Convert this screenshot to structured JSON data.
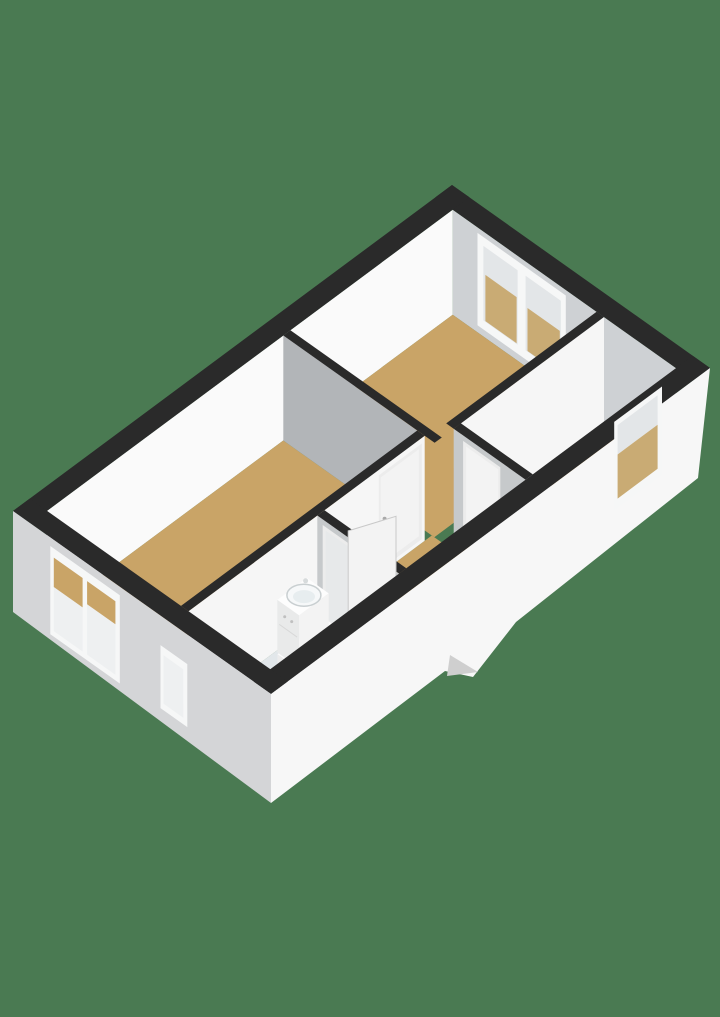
{
  "app": {
    "type": "3d-floorplan-render",
    "rooms_visible": 5,
    "text_labels": []
  },
  "palette": {
    "bg": "#4a7a52",
    "band": "#2a2a2a",
    "floorTan": "#c9a467",
    "floorBath": "#e2e7ea",
    "wallWhite": "#fafafa",
    "wallBright": "#f6f6f6",
    "wallGrayLt": "#ced1d4",
    "wallGrayMd": "#b2b5b8",
    "wallGrayDr": "#c6c9cb",
    "extSW": "#d4d5d7",
    "extSE": "#f7f7f7",
    "frame": "#f6f7f7",
    "doorFrame": "#ececec",
    "leaf": "#f3f3f3",
    "doorOpen": "#e7e9ea",
    "glass": "#e3e6e8",
    "glassLt": "#eef0f1",
    "reveal": "#c9ab74",
    "fixture": "#fbfbfb",
    "fixtureSide": "#ececec",
    "fixtureSide2": "#f3f3f3",
    "handle": "#a9a9a9",
    "edge": "#c9c9c9"
  },
  "scene": {
    "projection": {
      "origin": [
        452,
        185
      ],
      "a": [
        -47.72,
        35.43
      ],
      "b": [
        49.62,
        35.19
      ],
      "drop": 105,
      "length_m": 9.2,
      "width_m": 5.2
    },
    "elements": [
      {
        "t": "screenPoly",
        "pts": [
          [
            0,
            0
          ],
          [
            720,
            0
          ],
          [
            720,
            1017
          ],
          [
            0,
            1017
          ]
        ],
        "fill": "bg",
        "name": "background"
      },
      {
        "t": "faceB",
        "s": 0.35,
        "t0": 0.35,
        "t1": 4.85,
        "z0": 0,
        "z1": 1,
        "fill": "wallGrayLt",
        "name": "ne-wall-inner-face"
      },
      {
        "t": "faceA",
        "tt": 0.35,
        "s0": 0.35,
        "s1": 8.85,
        "z0": 0,
        "z1": 1,
        "fill": "wallWhite",
        "name": "nw-wall-inner-face"
      },
      {
        "t": "faceB",
        "s": 0.34,
        "t0": 0.84,
        "t1": 2.62,
        "z0": 0.06,
        "z1": 0.94,
        "fill": "frame",
        "name": "bedroom1-window-frame"
      },
      {
        "t": "faceB",
        "s": 0.33,
        "t0": 0.95,
        "t1": 1.64,
        "z0": 0.15,
        "z1": 0.86,
        "fill": "glass",
        "name": "bedroom1-window-pane-left"
      },
      {
        "t": "faceB",
        "s": 0.33,
        "t0": 1.8,
        "t1": 2.51,
        "z0": 0.15,
        "z1": 0.86,
        "fill": "glass",
        "name": "bedroom1-window-pane-right"
      },
      {
        "t": "faceB",
        "s": 0.32,
        "t0": 0.98,
        "t1": 1.61,
        "z0": 0.42,
        "z1": 0.86,
        "fill": "reveal",
        "name": "bedroom1-window-reveal-left"
      },
      {
        "t": "faceB",
        "s": 0.32,
        "t0": 1.83,
        "t1": 2.48,
        "z0": 0.45,
        "z1": 0.86,
        "fill": "reveal",
        "name": "bedroom1-window-reveal-right"
      },
      {
        "t": "rect",
        "s0": 0.35,
        "s1": 3.75,
        "t0": 0.35,
        "t1": 3.25,
        "z": 1,
        "fill": "floorTan",
        "name": "bedroom1-floor"
      },
      {
        "t": "rect",
        "s0": 0.35,
        "s1": 3.35,
        "t0": 3.4,
        "t1": 4.85,
        "z": 1,
        "fill": "floorTan",
        "name": "bedroom2-floor"
      },
      {
        "t": "rect",
        "s0": 3.9,
        "s1": 8.85,
        "t0": 0.35,
        "t1": 3.05,
        "z": 1,
        "fill": "floorTan",
        "name": "living-room-floor"
      },
      {
        "t": "polyPlan",
        "z": 1,
        "pts": [
          [
            3.75,
            3.2
          ],
          [
            3.75,
            3.4
          ],
          [
            3.5,
            3.4
          ],
          [
            3.5,
            4.85
          ],
          [
            6.0,
            4.85
          ],
          [
            6.0,
            3.2
          ]
        ],
        "fill": "floorTan",
        "name": "hallway-floor"
      },
      {
        "t": "rect",
        "s0": 6.15,
        "s1": 8.85,
        "t0": 3.2,
        "t1": 4.85,
        "z": 1,
        "fill": "floorBath",
        "name": "bathroom-floor"
      },
      {
        "t": "quad",
        "pts": [
          [
            3.47,
            4.35,
            0.05
          ],
          [
            2.7,
            4.6,
            0.05
          ],
          [
            2.7,
            4.6,
            1
          ],
          [
            3.47,
            4.35,
            1
          ]
        ],
        "fill": "leaf",
        "stroke": "edge",
        "name": "bedroom2-door-leaf-open"
      },
      {
        "t": "faceA",
        "tt": 3.4,
        "s0": 0.35,
        "s1": 3.35,
        "z0": 0,
        "z1": 1,
        "fill": "wallBright",
        "name": "partition-bed1-bed2-face"
      },
      {
        "t": "faceB",
        "s": 3.5,
        "t0": 3.4,
        "t1": 4.85,
        "z0": 0,
        "z1": 1,
        "fill": "wallGrayDr",
        "name": "partition-bed2-hall-face"
      },
      {
        "t": "faceB",
        "s": 3.49,
        "t0": 3.58,
        "t1": 4.33,
        "z0": 0.06,
        "z1": 0.97,
        "fill": "doorFrame",
        "name": "bedroom2-door-frame"
      },
      {
        "t": "faceB",
        "s": 3.48,
        "t0": 3.63,
        "t1": 4.28,
        "z0": 0.1,
        "z1": 0.93,
        "fill": "leaf",
        "name": "bedroom2-doorway"
      },
      {
        "t": "faceB",
        "s": 3.9,
        "t0": 0.35,
        "t1": 3.05,
        "z0": 0,
        "z1": 1,
        "fill": "wallGrayMd",
        "name": "partition-bed1-living-face"
      },
      {
        "t": "faceA",
        "tt": 3.2,
        "s0": 3.9,
        "s1": 8.85,
        "z0": 0,
        "z1": 1,
        "fill": "wallBright",
        "name": "partition-living-hall-face"
      },
      {
        "t": "faceA",
        "tt": 3.19,
        "s0": 3.95,
        "s1": 4.85,
        "z0": 0.06,
        "z1": 0.97,
        "fill": "doorFrame",
        "name": "living-room-door-frame"
      },
      {
        "t": "faceA",
        "tt": 3.18,
        "s0": 4.0,
        "s1": 4.8,
        "z0": 0.1,
        "z1": 0.93,
        "fill": "leaf",
        "name": "living-room-door"
      },
      {
        "t": "circle",
        "c": [
          4.72,
          3.18,
          0.52
        ],
        "r": 2,
        "fill": "handle",
        "name": "living-room-door-handle"
      },
      {
        "t": "faceB",
        "s": 6.15,
        "t0": 3.2,
        "t1": 4.85,
        "z0": 0,
        "z1": 1,
        "fill": "wallGrayDr",
        "name": "bathroom-wall-face"
      },
      {
        "t": "faceB",
        "s": 6.14,
        "t0": 3.3,
        "t1": 4.0,
        "z0": 0.06,
        "z1": 0.97,
        "fill": "doorFrame",
        "name": "bathroom-door-frame"
      },
      {
        "t": "faceB",
        "s": 6.13,
        "t0": 3.35,
        "t1": 3.95,
        "z0": 0.1,
        "z1": 0.93,
        "fill": "doorOpen",
        "name": "bathroom-doorway"
      },
      {
        "t": "rect",
        "s0": 0,
        "s1": 0.35,
        "t0": 0,
        "t1": 5.2,
        "z": 0,
        "fill": "band",
        "name": "ne-wall-top"
      },
      {
        "t": "rect",
        "s0": 0,
        "s1": 9.2,
        "t0": 0,
        "t1": 0.35,
        "z": 0,
        "fill": "band",
        "name": "nw-wall-top"
      },
      {
        "t": "rect",
        "s0": 0.35,
        "s1": 3.5,
        "t0": 3.25,
        "t1": 3.4,
        "z": 0,
        "fill": "band",
        "name": "partition-bed1-bed2-top"
      },
      {
        "t": "rect",
        "s0": 3.35,
        "s1": 3.5,
        "t0": 3.4,
        "t1": 4.85,
        "z": 0,
        "fill": "band",
        "name": "partition-bed2-hall-top"
      },
      {
        "t": "rect",
        "s0": 3.75,
        "s1": 3.9,
        "t0": 0.35,
        "t1": 3.4,
        "z": 0,
        "fill": "band",
        "name": "partition-bed1-living-top"
      },
      {
        "t": "rect",
        "s0": 3.9,
        "s1": 8.85,
        "t0": 3.05,
        "t1": 3.2,
        "z": 0,
        "fill": "band",
        "name": "partition-living-hall-top"
      },
      {
        "t": "rect",
        "s0": 6.0,
        "s1": 6.15,
        "t0": 3.2,
        "t1": 4.85,
        "z": 0,
        "fill": "band",
        "name": "bathroom-wall-top"
      },
      {
        "t": "quad",
        "pts": [
          [
            5.98,
            3.66,
            0.05
          ],
          [
            5.28,
            3.95,
            0.05
          ],
          [
            5.28,
            3.95,
            1
          ],
          [
            5.98,
            3.66,
            1
          ]
        ],
        "fill": "leaf",
        "stroke": "edge",
        "name": "bathroom-door-leaf-open"
      },
      {
        "t": "rect",
        "s0": 6.35,
        "s1": 7.35,
        "t0": 3.55,
        "t1": 4.4,
        "z": 0.8,
        "fill": "fixture",
        "name": "shower-tray-top"
      },
      {
        "t": "faceB",
        "s": 7.35,
        "t0": 3.55,
        "t1": 4.4,
        "z0": 0.8,
        "z1": 1,
        "fill": "fixtureSide",
        "name": "shower-tray-front"
      },
      {
        "t": "faceA",
        "tt": 4.4,
        "s0": 6.35,
        "s1": 7.35,
        "z0": 0.8,
        "z1": 1,
        "fill": "fixtureSide2",
        "name": "shower-tray-side"
      },
      {
        "t": "ellipse",
        "c": [
          6.28,
          3.97,
          0.78
        ],
        "rx": 7,
        "ry": 4.5,
        "fill": "#ffffff",
        "stroke": "#d2d5d6",
        "name": "toilet"
      },
      {
        "t": "rect",
        "s0": 6.4,
        "s1": 7.02,
        "t0": 3.23,
        "t1": 3.67,
        "z": 0.5,
        "fill": "#fdfdfd",
        "name": "sink-cabinet-top"
      },
      {
        "t": "faceB",
        "s": 7.02,
        "t0": 3.23,
        "t1": 3.67,
        "z0": 0.5,
        "z1": 1,
        "fill": "#e9eaea",
        "name": "sink-cabinet-front"
      },
      {
        "t": "faceA",
        "tt": 3.67,
        "s0": 6.4,
        "s1": 7.02,
        "z0": 0.5,
        "z1": 1,
        "fill": "#f3f3f3",
        "name": "sink-cabinet-side"
      },
      {
        "t": "line",
        "p1": [
          7.02,
          3.27,
          0.72
        ],
        "p2": [
          7.02,
          3.63,
          0.72
        ],
        "stroke": "#d8d8d8",
        "name": "sink-cabinet-drawer-line"
      },
      {
        "t": "circle",
        "c": [
          7.02,
          3.38,
          0.61
        ],
        "r": 1.5,
        "fill": "#c0c0c0",
        "name": "sink-cabinet-handle-1"
      },
      {
        "t": "circle",
        "c": [
          7.02,
          3.52,
          0.61
        ],
        "r": 1.5,
        "fill": "#c0c0c0",
        "name": "sink-cabinet-handle-2"
      },
      {
        "t": "ellipse",
        "c": [
          6.68,
          3.44,
          0.5
        ],
        "rx": 17,
        "ry": 11,
        "fill": "#f6f8f9",
        "stroke": "#c9cfd1",
        "name": "sink-basin"
      },
      {
        "t": "ellipse",
        "c": [
          6.7,
          3.46,
          0.5
        ],
        "rx": 11,
        "ry": 6.5,
        "fill": "#e7edef",
        "name": "sink-basin-inner"
      },
      {
        "t": "circle",
        "c": [
          6.5,
          3.3,
          0.47
        ],
        "r": 2.5,
        "fill": "#d7dbdc",
        "name": "sink-faucet"
      },
      {
        "t": "rect",
        "s0": 5.32,
        "s1": 5.92,
        "t0": 4.44,
        "t1": 4.84,
        "z": 0.99,
        "fill": "#f2f2f2",
        "name": "entrance-mat"
      },
      {
        "t": "rect",
        "s0": 0,
        "s1": 9.2,
        "t0": 4.85,
        "t1": 5.2,
        "z": 0,
        "fill": "band",
        "name": "se-wall-top"
      },
      {
        "t": "screenPoly",
        "pts": [
          [
            710,
            368
          ],
          [
            271,
            694
          ],
          [
            271,
            803
          ],
          [
            445,
            671
          ],
          [
            473,
            677
          ],
          [
            516,
            622
          ],
          [
            698,
            478
          ]
        ],
        "fill": "extSE",
        "name": "se-exterior-wall"
      },
      {
        "t": "screenPoly",
        "pts": [
          [
            450,
            655
          ],
          [
            478,
            672
          ],
          [
            447,
            676
          ]
        ],
        "fill": "#cfcfcf",
        "name": "entrance-porch-step"
      },
      {
        "t": "faceA",
        "tt": 5.02,
        "s0": 0.82,
        "s1": 1.82,
        "z0": -0.04,
        "z1": 0.8,
        "fill": "frame",
        "name": "bedroom2-window-frame"
      },
      {
        "t": "faceA",
        "tt": 5.01,
        "s0": 0.9,
        "s1": 1.74,
        "z0": 0.02,
        "z1": 0.3,
        "fill": "glass",
        "name": "bedroom2-window-glass"
      },
      {
        "t": "faceA",
        "tt": 5.01,
        "s0": 0.9,
        "s1": 1.74,
        "z0": 0.3,
        "z1": 0.72,
        "fill": "reveal",
        "name": "bedroom2-window-reveal"
      },
      {
        "t": "rect",
        "s0": 8.85,
        "s1": 9.2,
        "t0": 0,
        "t1": 5.2,
        "z": 0,
        "fill": "band",
        "name": "sw-wall-top"
      },
      {
        "t": "screenPoly",
        "pts": [
          [
            13,
            511
          ],
          [
            271,
            694
          ],
          [
            271,
            803
          ],
          [
            13,
            612
          ]
        ],
        "fill": "extSW",
        "name": "sw-exterior-wall"
      },
      {
        "t": "faceB",
        "s": 9.02,
        "t0": 0.58,
        "t1": 1.98,
        "z0": 0.2,
        "z1": 1.04,
        "fill": "frame",
        "name": "living-room-window-frame"
      },
      {
        "t": "faceB",
        "s": 9.03,
        "t0": 0.66,
        "t1": 1.24,
        "z0": 0.28,
        "z1": 0.98,
        "fill": "glassLt",
        "name": "living-room-window-pane-left"
      },
      {
        "t": "faceB",
        "s": 9.03,
        "t0": 0.66,
        "t1": 1.24,
        "z0": 0.28,
        "z1": 0.56,
        "fill": "floorTan",
        "name": "living-room-window-view-left"
      },
      {
        "t": "faceB",
        "s": 9.03,
        "t0": 1.33,
        "t1": 1.9,
        "z0": 0.28,
        "z1": 0.98,
        "fill": "glassLt",
        "name": "living-room-window-pane-right"
      },
      {
        "t": "faceB",
        "s": 9.03,
        "t0": 1.33,
        "t1": 1.9,
        "z0": 0.28,
        "z1": 0.5,
        "fill": "floorTan",
        "name": "living-room-window-view-right"
      },
      {
        "t": "faceB",
        "s": 9.02,
        "t0": 2.8,
        "t1": 3.34,
        "z0": 0.4,
        "z1": 1.0,
        "fill": "frame",
        "name": "bathroom-window-frame"
      },
      {
        "t": "faceB",
        "s": 9.03,
        "t0": 2.87,
        "t1": 3.27,
        "z0": 0.47,
        "z1": 0.93,
        "fill": "glassLt",
        "name": "bathroom-window-glass"
      }
    ]
  }
}
